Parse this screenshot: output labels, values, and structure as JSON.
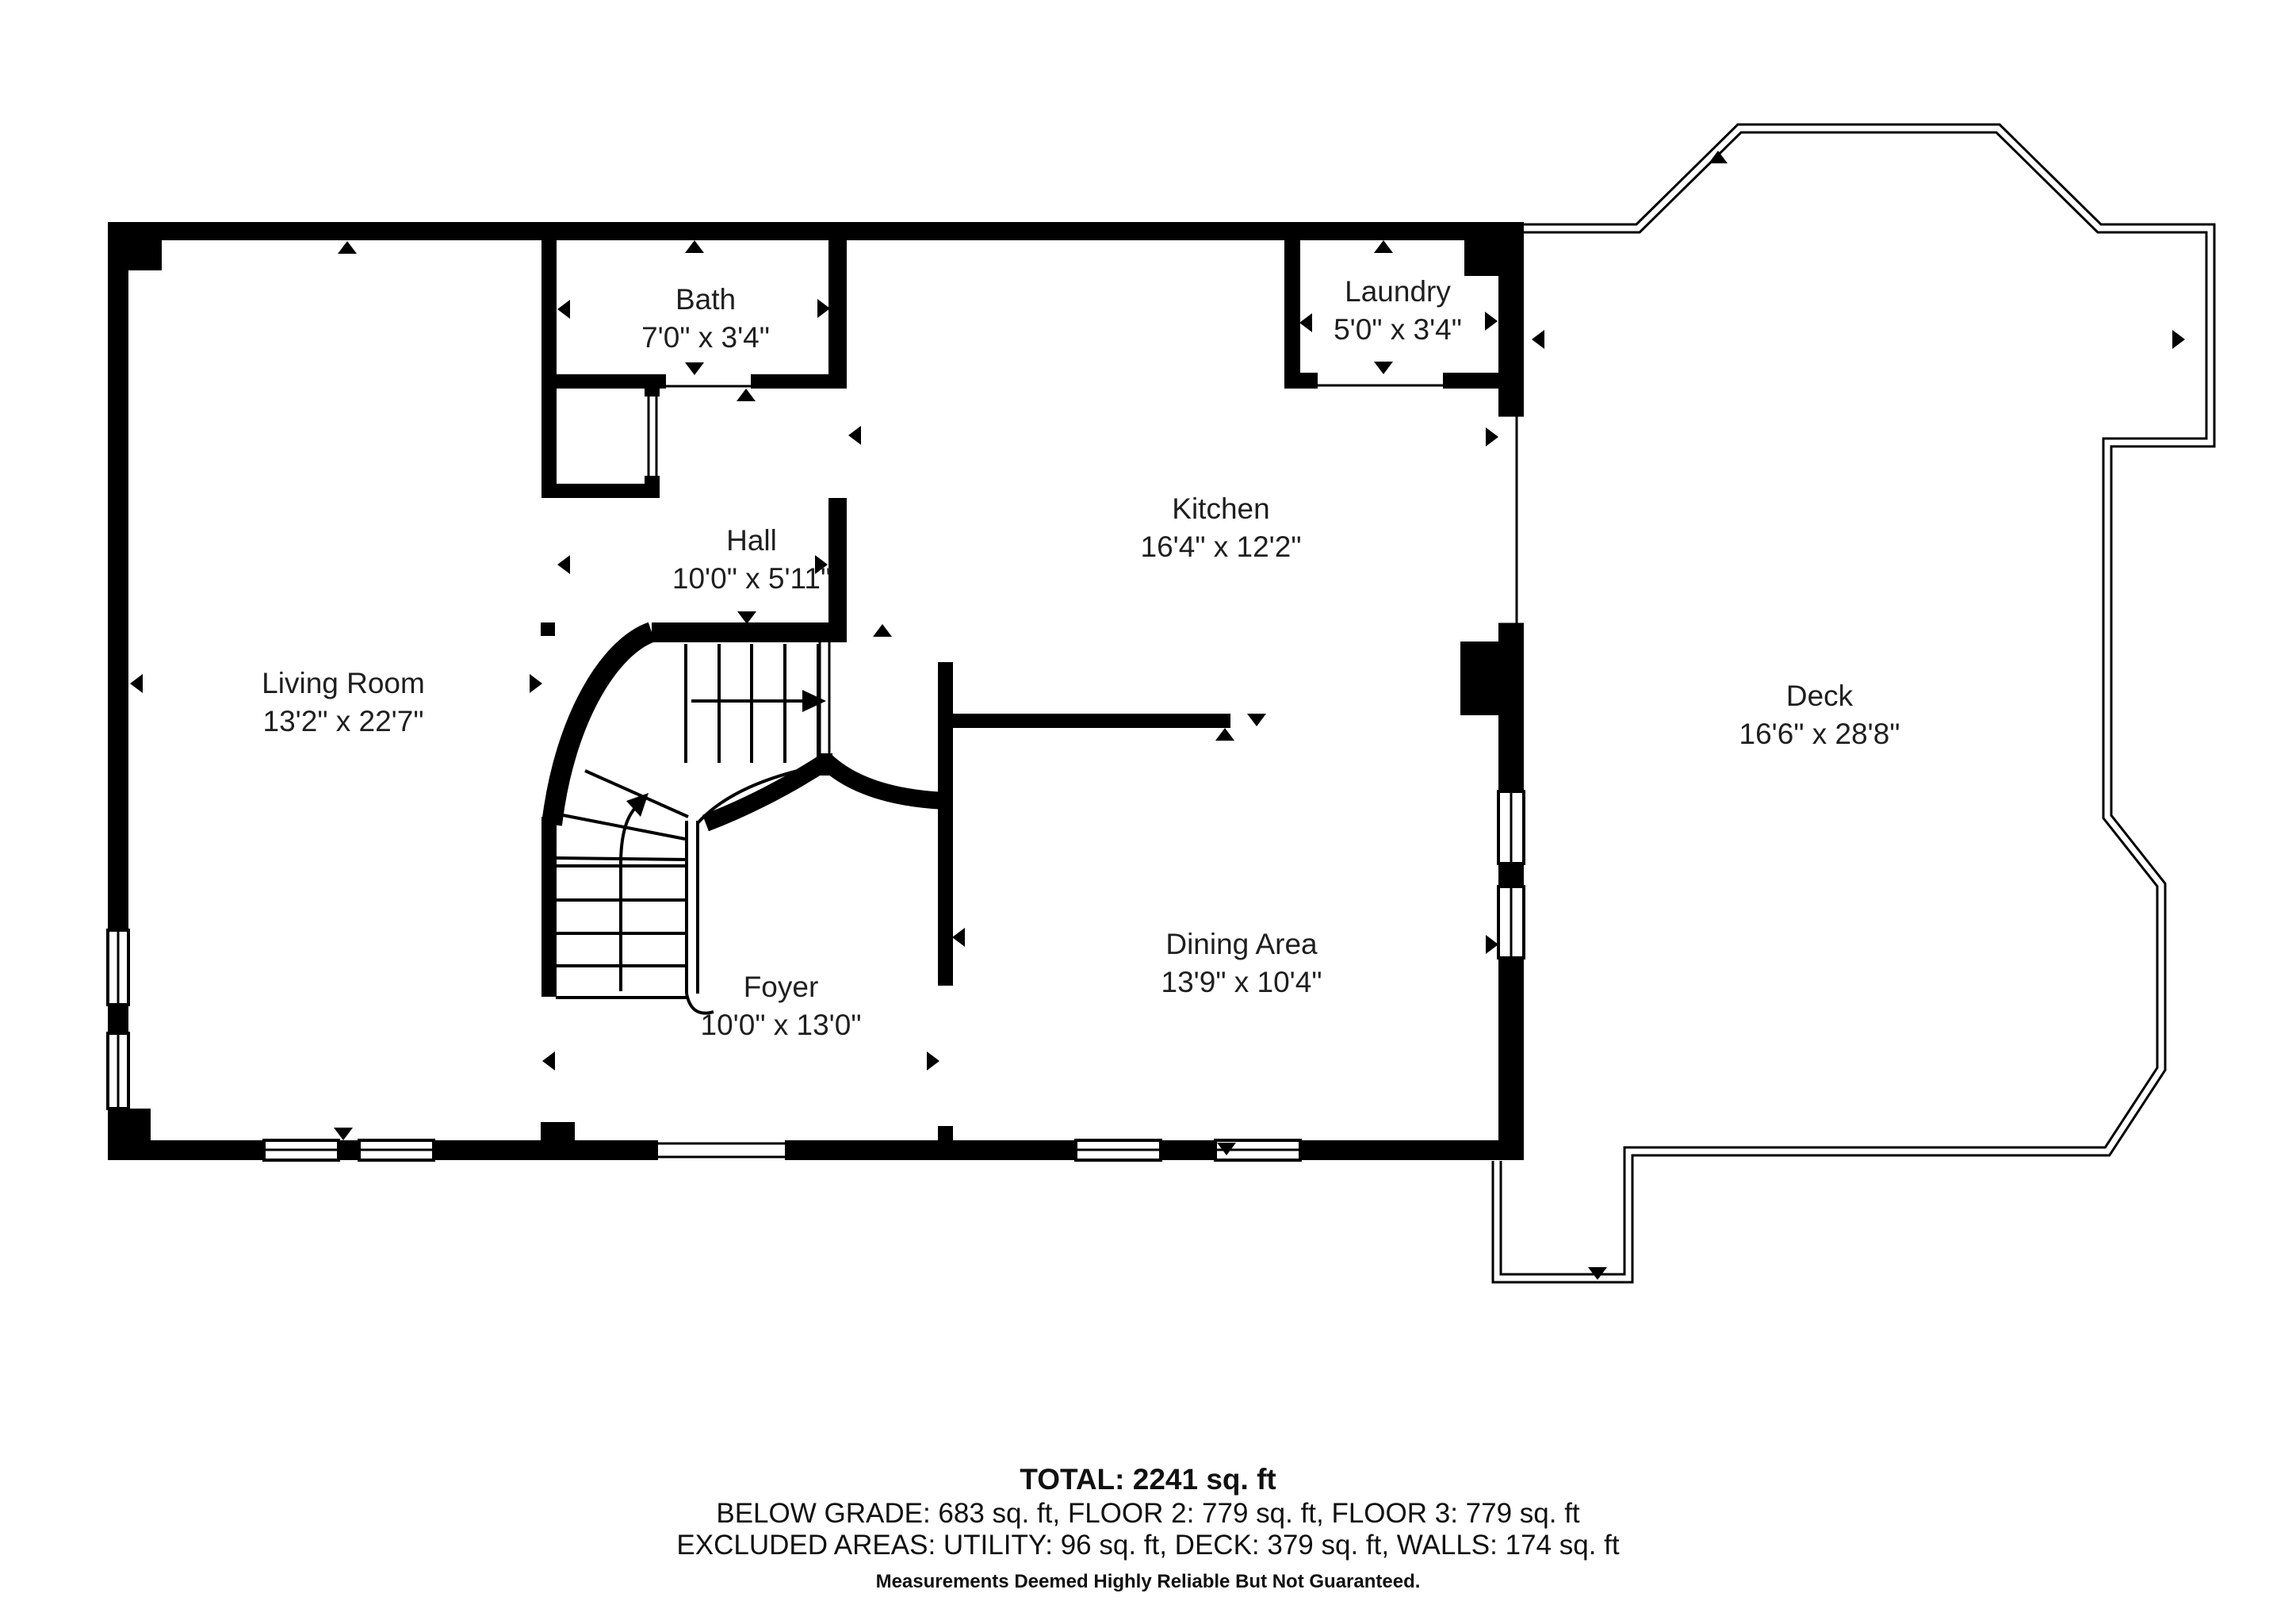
{
  "rooms": [
    {
      "id": "living-room",
      "name": "Living Room",
      "dims": "13'2\" x 22'7\""
    },
    {
      "id": "bath",
      "name": "Bath",
      "dims": "7'0\" x 3'4\""
    },
    {
      "id": "hall",
      "name": "Hall",
      "dims": "10'0\" x 5'11\""
    },
    {
      "id": "kitchen",
      "name": "Kitchen",
      "dims": "16'4\" x 12'2\""
    },
    {
      "id": "laundry",
      "name": "Laundry",
      "dims": "5'0\" x 3'4\""
    },
    {
      "id": "foyer",
      "name": "Foyer",
      "dims": "10'0\" x 13'0\""
    },
    {
      "id": "dining-area",
      "name": "Dining Area",
      "dims": "13'9\" x 10'4\""
    },
    {
      "id": "deck",
      "name": "Deck",
      "dims": "16'6\" x 28'8\""
    }
  ],
  "footer": {
    "total": "TOTAL: 2241 sq. ft",
    "floors": "BELOW GRADE: 683 sq. ft, FLOOR 2: 779 sq. ft, FLOOR 3: 779 sq. ft",
    "excluded": "EXCLUDED AREAS: UTILITY: 96 sq. ft, DECK: 379 sq. ft, WALLS: 174 sq. ft",
    "disclaimer": "Measurements Deemed Highly Reliable But Not Guaranteed."
  },
  "colors": {
    "wall": "#000000",
    "text": "#1f1f1f",
    "background": "#ffffff"
  }
}
